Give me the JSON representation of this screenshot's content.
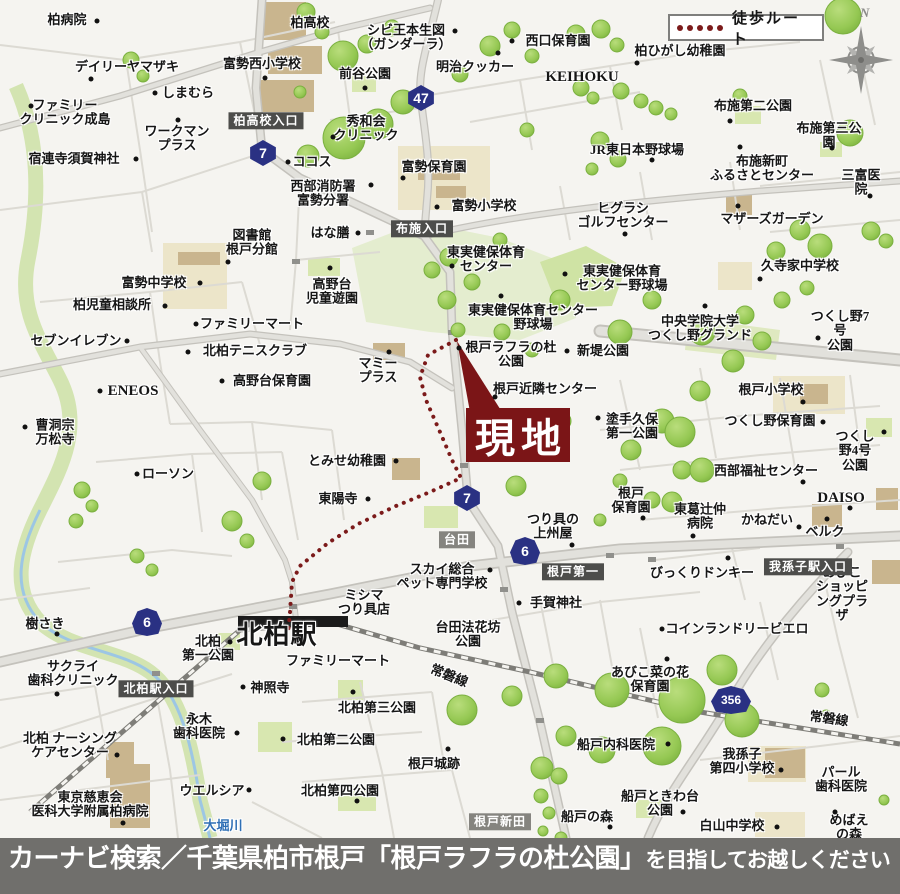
{
  "colors": {
    "walk_route": "#7b1a1a",
    "site_bg": "#7b1517",
    "shield_bg": "#2a3183",
    "badge_bg": "#4d4d4b",
    "badge_light_bg": "#85847f",
    "caption_bg": "#706f6c",
    "river_text": "#2f6fb5"
  },
  "legend": {
    "label": "徒歩ルート"
  },
  "compass": {
    "north_label": "N"
  },
  "site_marker": {
    "label": "現地"
  },
  "caption": {
    "main": "カーナビ検索／千葉県柏市根戸「根戸ラフラの杜公園」",
    "suffix": "を目指してお越しください"
  },
  "road_badges": [
    {
      "t": "柏高校入口",
      "x": 266,
      "y": 121
    },
    {
      "t": "布施入口",
      "x": 422,
      "y": 229
    },
    {
      "t": "台田",
      "x": 457,
      "y": 540,
      "light": true
    },
    {
      "t": "根戸第一",
      "x": 573,
      "y": 572
    },
    {
      "t": "我孫子駅入口",
      "x": 808,
      "y": 567
    },
    {
      "t": "北柏駅入口",
      "x": 156,
      "y": 689
    },
    {
      "t": "根戸新田",
      "x": 500,
      "y": 822,
      "light": true
    }
  ],
  "route_shields": [
    {
      "n": "47",
      "x": 421,
      "y": 98,
      "s": "hex"
    },
    {
      "n": "7",
      "x": 263,
      "y": 153,
      "s": "hex"
    },
    {
      "n": "7",
      "x": 467,
      "y": 498,
      "s": "hex"
    },
    {
      "n": "6",
      "x": 147,
      "y": 622,
      "s": "oni"
    },
    {
      "n": "6",
      "x": 525,
      "y": 551,
      "s": "oni"
    },
    {
      "n": "356",
      "x": 731,
      "y": 700,
      "s": "oni",
      "w": 40,
      "fs": 12
    }
  ],
  "rail_name": "常磐線",
  "river_name": "大堀川",
  "station_name": "北柏駅",
  "labels": [
    {
      "t": "柏病院",
      "x": 67,
      "y": 20,
      "d": [
        97,
        21
      ]
    },
    {
      "t": "デイリーヤマザキ",
      "x": 127,
      "y": 67,
      "d": [
        91,
        79
      ]
    },
    {
      "t": "しまむら",
      "x": 188,
      "y": 93,
      "d": [
        155,
        93
      ]
    },
    {
      "t": "ファミリー\nクリニック成島",
      "x": 65,
      "y": 113,
      "d": [
        31,
        106
      ]
    },
    {
      "t": "ワークマン\nプラス",
      "x": 177,
      "y": 139,
      "d": [
        178,
        120
      ]
    },
    {
      "t": "宿連寺須賀神社",
      "x": 74,
      "y": 159,
      "d": [
        136,
        159
      ]
    },
    {
      "t": "富勢西小学校",
      "x": 262,
      "y": 64,
      "d": [
        265,
        78
      ]
    },
    {
      "t": "柏高校",
      "x": 310,
      "y": 23
    },
    {
      "t": "シビ王本生図\n（ガンダーラ）",
      "x": 406,
      "y": 38,
      "d": [
        455,
        31
      ]
    },
    {
      "t": "前谷公園",
      "x": 365,
      "y": 74,
      "d": [
        365,
        88
      ]
    },
    {
      "t": "明治クッカー",
      "x": 475,
      "y": 67,
      "d": [
        498,
        53
      ]
    },
    {
      "t": "西口保育園",
      "x": 558,
      "y": 41,
      "d": [
        512,
        41
      ]
    },
    {
      "t": "KEIHOKU",
      "x": 582,
      "y": 77,
      "fs": 15
    },
    {
      "t": "柏ひがし幼稚園",
      "x": 680,
      "y": 51,
      "d": [
        637,
        63
      ]
    },
    {
      "t": "布施第二公園",
      "x": 753,
      "y": 106,
      "d": [
        730,
        121
      ]
    },
    {
      "t": "布施第三公園",
      "x": 829,
      "y": 136,
      "d": [
        832,
        148
      ]
    },
    {
      "t": "秀和会\nクリニック",
      "x": 366,
      "y": 129,
      "d": [
        333,
        137
      ]
    },
    {
      "t": "ココス",
      "x": 312,
      "y": 162,
      "d": [
        288,
        162
      ]
    },
    {
      "t": "西部消防署\n富勢分署",
      "x": 323,
      "y": 194,
      "d": [
        371,
        185
      ]
    },
    {
      "t": "富勢保育園",
      "x": 434,
      "y": 167,
      "d": [
        403,
        178
      ]
    },
    {
      "t": "富勢小学校",
      "x": 484,
      "y": 206,
      "d": [
        437,
        207
      ]
    },
    {
      "t": "はな膳",
      "x": 330,
      "y": 233,
      "d": [
        358,
        233
      ]
    },
    {
      "t": "JR東日本野球場",
      "x": 637,
      "y": 150,
      "d": [
        652,
        160
      ]
    },
    {
      "t": "布施新町\nふるさとセンター",
      "x": 762,
      "y": 169,
      "d": [
        740,
        147
      ]
    },
    {
      "t": "三富医院",
      "x": 861,
      "y": 183,
      "d": [
        870,
        196
      ]
    },
    {
      "t": "ヒグラシ\nゴルフセンター",
      "x": 623,
      "y": 216,
      "d": [
        625,
        234
      ]
    },
    {
      "t": "マザーズガーデン",
      "x": 772,
      "y": 219,
      "d": [
        738,
        206
      ]
    },
    {
      "t": "久寺家中学校",
      "x": 800,
      "y": 266,
      "d": [
        760,
        279
      ]
    },
    {
      "t": "図書館\n根戸分館",
      "x": 252,
      "y": 243,
      "d": [
        228,
        262
      ]
    },
    {
      "t": "富勢中学校",
      "x": 154,
      "y": 283,
      "d": [
        200,
        283
      ]
    },
    {
      "t": "柏児童相談所",
      "x": 112,
      "y": 305,
      "d": [
        165,
        306
      ]
    },
    {
      "t": "高野台\n児童遊園",
      "x": 332,
      "y": 292,
      "d": [
        330,
        268
      ]
    },
    {
      "t": "東実健保体育\nセンター",
      "x": 486,
      "y": 260,
      "d": [
        452,
        266
      ]
    },
    {
      "t": "東実健保体育\nセンター野球場",
      "x": 622,
      "y": 279,
      "d": [
        565,
        274
      ]
    },
    {
      "t": "東実健保体育センター\n野球場",
      "x": 533,
      "y": 318,
      "d": [
        501,
        296
      ]
    },
    {
      "t": "中央学院大学\nつくし野グランド",
      "x": 700,
      "y": 329,
      "d": [
        705,
        306
      ]
    },
    {
      "t": "つくし野7号\n公園",
      "x": 840,
      "y": 331,
      "d": [
        818,
        338
      ]
    },
    {
      "t": "ファミリーマート",
      "x": 252,
      "y": 324,
      "d": [
        196,
        324
      ]
    },
    {
      "t": "北柏テニスクラブ",
      "x": 255,
      "y": 351,
      "d": [
        188,
        352
      ]
    },
    {
      "t": "高野台保育園",
      "x": 272,
      "y": 381,
      "d": [
        222,
        381
      ]
    },
    {
      "t": "セブンイレブン",
      "x": 76,
      "y": 341,
      "d": [
        127,
        341
      ]
    },
    {
      "t": "ENEOS",
      "x": 133,
      "y": 391,
      "fs": 15,
      "d": [
        100,
        391
      ]
    },
    {
      "t": "マミー\nプラス",
      "x": 378,
      "y": 371,
      "d": [
        389,
        352
      ]
    },
    {
      "t": "根戸ラフラの杜\n公園",
      "x": 511,
      "y": 355,
      "d": [
        459,
        348
      ]
    },
    {
      "t": "新堤公園",
      "x": 603,
      "y": 351,
      "d": [
        567,
        351
      ]
    },
    {
      "t": "根戸近隣センター",
      "x": 545,
      "y": 389,
      "d": [
        495,
        397
      ]
    },
    {
      "t": "根戸小学校",
      "x": 771,
      "y": 390,
      "d": [
        803,
        402
      ]
    },
    {
      "t": "塗手久保\n第一公園",
      "x": 632,
      "y": 427,
      "d": [
        598,
        418
      ]
    },
    {
      "t": "つくし野保育園",
      "x": 770,
      "y": 421,
      "d": [
        823,
        422
      ]
    },
    {
      "t": "曹洞宗\n万松寺",
      "x": 55,
      "y": 433,
      "d": [
        25,
        427
      ]
    },
    {
      "t": "つくし野4号\n公園",
      "x": 855,
      "y": 451,
      "d": [
        884,
        432
      ]
    },
    {
      "t": "西部福祉センター",
      "x": 766,
      "y": 471,
      "d": [
        803,
        482
      ]
    },
    {
      "t": "ローソン",
      "x": 168,
      "y": 474,
      "d": [
        137,
        474
      ]
    },
    {
      "t": "とみせ幼稚園",
      "x": 347,
      "y": 461,
      "d": [
        396,
        461
      ]
    },
    {
      "t": "東陽寺",
      "x": 338,
      "y": 499,
      "d": [
        368,
        499
      ]
    },
    {
      "t": "根戸\n保育園",
      "x": 631,
      "y": 501,
      "d": [
        643,
        518
      ]
    },
    {
      "t": "東葛辻仲\n病院",
      "x": 700,
      "y": 517,
      "d": [
        693,
        536
      ]
    },
    {
      "t": "かねだい",
      "x": 767,
      "y": 520,
      "d": [
        799,
        527
      ]
    },
    {
      "t": "DAISO",
      "x": 841,
      "y": 498,
      "fs": 15,
      "d": [
        850,
        508
      ]
    },
    {
      "t": "ベルク",
      "x": 825,
      "y": 532,
      "d": [
        827,
        519
      ]
    },
    {
      "t": "つり具の\n上州屋",
      "x": 553,
      "y": 527,
      "d": [
        572,
        545
      ]
    },
    {
      "t": "びっくりドンキー",
      "x": 702,
      "y": 573,
      "d": [
        728,
        558
      ]
    },
    {
      "t": "あびこ\nショッピングプラザ",
      "x": 842,
      "y": 594
    },
    {
      "t": "スカイ総合\nペット専門学校",
      "x": 442,
      "y": 577,
      "d": [
        490,
        570
      ]
    },
    {
      "t": "ミシマ\nつり具店",
      "x": 364,
      "y": 603
    },
    {
      "t": "手賀神社",
      "x": 556,
      "y": 603,
      "d": [
        519,
        603
      ]
    },
    {
      "t": "台田法花坊\n公園",
      "x": 468,
      "y": 635
    },
    {
      "t": "樹さき",
      "x": 45,
      "y": 624,
      "d": [
        57,
        634
      ]
    },
    {
      "t": "サクライ\n歯科クリニック",
      "x": 73,
      "y": 674,
      "d": [
        57,
        694
      ]
    },
    {
      "t": "北柏\n第一公園",
      "x": 208,
      "y": 649,
      "d": [
        230,
        642
      ]
    },
    {
      "t": "神照寺",
      "x": 270,
      "y": 688,
      "d": [
        243,
        687
      ]
    },
    {
      "t": "ファミリーマート",
      "x": 338,
      "y": 661
    },
    {
      "t": "永木\n歯科医院",
      "x": 199,
      "y": 727,
      "d": [
        237,
        733
      ]
    },
    {
      "t": "北柏 ナーシング\nケアセンター",
      "x": 70,
      "y": 746,
      "d": [
        117,
        755
      ]
    },
    {
      "t": "北柏第三公園",
      "x": 377,
      "y": 708,
      "d": [
        353,
        692
      ]
    },
    {
      "t": "北柏第二公園",
      "x": 336,
      "y": 740,
      "d": [
        283,
        739
      ]
    },
    {
      "t": "北柏第四公園",
      "x": 340,
      "y": 791,
      "d": [
        357,
        801
      ]
    },
    {
      "t": "根戸城跡",
      "x": 434,
      "y": 764,
      "d": [
        448,
        749
      ]
    },
    {
      "t": "東京慈恵会\n医科大学附属柏病院",
      "x": 90,
      "y": 805,
      "d": [
        123,
        823
      ]
    },
    {
      "t": "ウエルシア",
      "x": 212,
      "y": 791,
      "d": [
        249,
        790
      ]
    },
    {
      "t": "大堀川",
      "x": 223,
      "y": 826,
      "c": "#2f6fb5",
      "n": "river-label"
    },
    {
      "t": "船戸内科医院",
      "x": 616,
      "y": 745,
      "d": [
        668,
        744
      ]
    },
    {
      "t": "あびこ菜の花\n保育園",
      "x": 650,
      "y": 680,
      "d": [
        667,
        659
      ]
    },
    {
      "t": "コインランドリービエロ",
      "x": 737,
      "y": 629,
      "d": [
        662,
        629
      ]
    },
    {
      "t": "我孫子\n第四小学校",
      "x": 742,
      "y": 762,
      "d": [
        781,
        770
      ]
    },
    {
      "t": "パール\n歯科医院",
      "x": 841,
      "y": 780
    },
    {
      "t": "船戸ときわ台\n公園",
      "x": 660,
      "y": 804,
      "d": [
        683,
        812
      ]
    },
    {
      "t": "船戸の森",
      "x": 587,
      "y": 817,
      "d": [
        610,
        827
      ]
    },
    {
      "t": "白山中学校",
      "x": 732,
      "y": 826,
      "d": [
        777,
        827
      ]
    },
    {
      "t": "めばえの森",
      "x": 849,
      "y": 828,
      "d": [
        835,
        812
      ]
    },
    {
      "t": "北柏駅",
      "x": 277,
      "y": 636,
      "fs": 26,
      "n": "station-label"
    },
    {
      "t": "常磐線",
      "x": 449,
      "y": 676,
      "rot": 22,
      "n": "railway-label"
    },
    {
      "t": "常磐線",
      "x": 829,
      "y": 719,
      "rot": 8,
      "n": "railway-label"
    }
  ]
}
